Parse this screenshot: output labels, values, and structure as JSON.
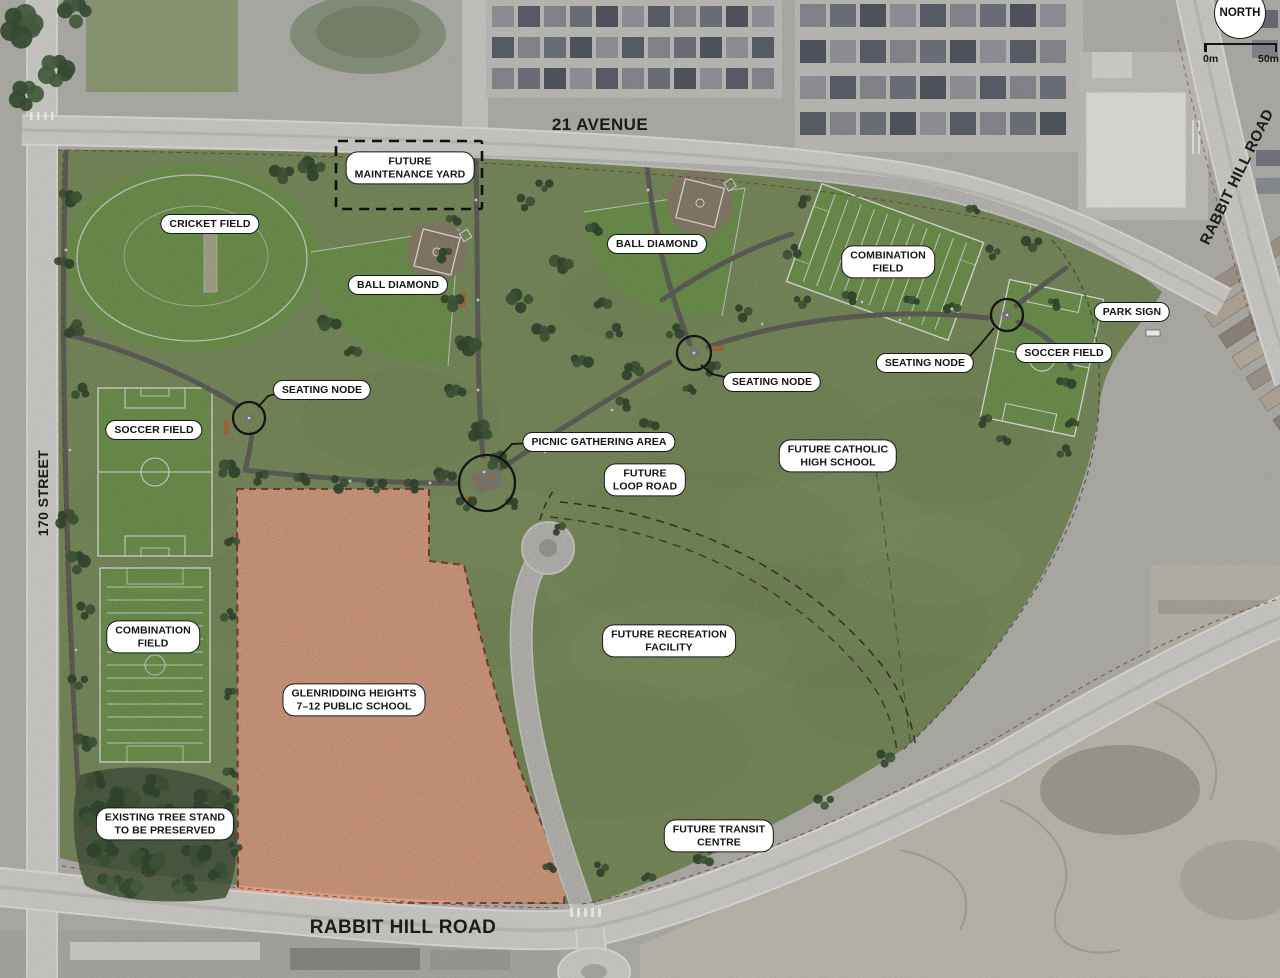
{
  "map": {
    "compass_label": "NORTH",
    "scale": {
      "start_label": "0m",
      "end_label": "50m"
    }
  },
  "colors": {
    "park_green": "#8ca06b",
    "field_green": "#7fa75a",
    "school_orange": "#efb091",
    "road_gray": "#d6d5d1",
    "aerial_gray": "#b9b7b1",
    "path_gray": "#6f6e66",
    "tree_green": "#47603f",
    "label_bg": "#ffffff",
    "label_border": "#1a1a1a"
  },
  "roads": [
    {
      "id": "21-avenue",
      "label": "21 AVENUE"
    },
    {
      "id": "rabbit-hill-road-east",
      "label": "RABBIT HILL ROAD"
    },
    {
      "id": "170-street",
      "label": "170 STREET"
    },
    {
      "id": "rabbit-hill-road-south",
      "label": "RABBIT HILL ROAD"
    }
  ],
  "features": [
    {
      "id": "cricket-field",
      "label": "CRICKET FIELD"
    },
    {
      "id": "future-maintenance-yard",
      "label": "FUTURE\nMAINTENANCE YARD"
    },
    {
      "id": "ball-diamond-west",
      "label": "BALL DIAMOND"
    },
    {
      "id": "ball-diamond-central",
      "label": "BALL DIAMOND"
    },
    {
      "id": "combination-field-east",
      "label": "COMBINATION\nFIELD"
    },
    {
      "id": "park-sign",
      "label": "PARK SIGN"
    },
    {
      "id": "seating-node-east",
      "label": "SEATING NODE"
    },
    {
      "id": "soccer-field-east",
      "label": "SOCCER FIELD"
    },
    {
      "id": "seating-node-west",
      "label": "SEATING NODE"
    },
    {
      "id": "seating-node-central",
      "label": "SEATING NODE"
    },
    {
      "id": "soccer-field-west",
      "label": "SOCCER FIELD"
    },
    {
      "id": "picnic-gathering-area",
      "label": "PICNIC GATHERING AREA"
    },
    {
      "id": "future-catholic-high-school",
      "label": "FUTURE CATHOLIC\nHIGH SCHOOL"
    },
    {
      "id": "future-loop-road",
      "label": "FUTURE\nLOOP ROAD"
    },
    {
      "id": "combination-field-west",
      "label": "COMBINATION\nFIELD"
    },
    {
      "id": "glenridding-heights-school",
      "label": "GLENRIDDING HEIGHTS\n7–12 PUBLIC SCHOOL"
    },
    {
      "id": "future-recreation-facility",
      "label": "FUTURE RECREATION\nFACILITY"
    },
    {
      "id": "existing-tree-stand",
      "label": "EXISTING TREE STAND\nTO BE PRESERVED"
    },
    {
      "id": "future-transit-centre",
      "label": "FUTURE TRANSIT\nCENTRE"
    }
  ]
}
